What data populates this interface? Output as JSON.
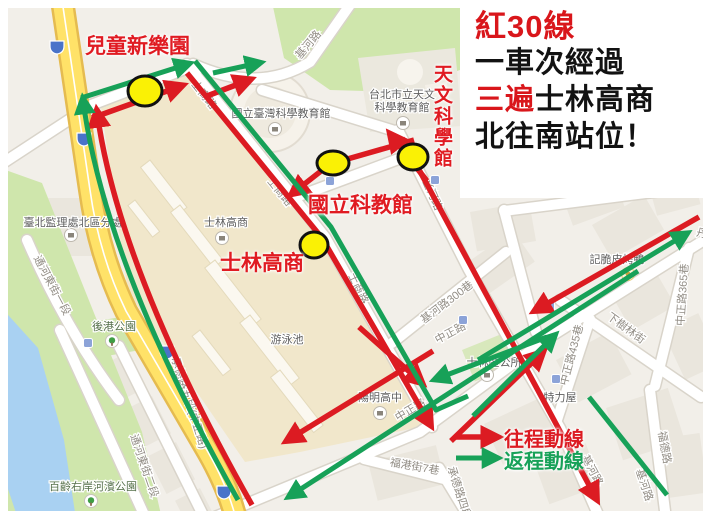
{
  "colors": {
    "route_red": "#DC1B22",
    "route_green": "#17A158",
    "stop_yellow": "#FAF105",
    "annotation_red": "#E01B22",
    "title_red": "#D9161B",
    "road_yellow": "#FFE268",
    "park_green": "#CFE6AC",
    "water_blue": "#A9D1F2"
  },
  "title_box": {
    "line1": "紅30線",
    "line2": "一車次經過",
    "line3_red": "三遍",
    "line3_black": "士林高商",
    "line4": "北往南站位！"
  },
  "stop_labels": {
    "ertong": "兒童新樂園",
    "tianwen": "天文科學館",
    "kejiao": "國立科教館",
    "shilin": "士林高商"
  },
  "legend": {
    "outbound": "往程動線",
    "inbound": "返程動線"
  },
  "map": {
    "streets": {
      "jihe": "基河路",
      "shishang": "士商路",
      "zhongzheng": "中正路",
      "jihe300": "基河路300巷",
      "zz365": "中正路365巷",
      "zz435": "中正路435巷",
      "xiashulin": "下樹林街",
      "chengde5": "承德路五段(中正路)",
      "chengde4": "承德路四段",
      "tonghe1": "通河東街一段",
      "tonghe2": "通河東街二段",
      "fugang7": "福港街7巷",
      "fude": "福德路",
      "danyang": "丹陽街"
    },
    "pois": {
      "sci_edu": "國立臺灣科學教育館",
      "astro_l1": "台北市立天文",
      "astro_l2": "科學教育館",
      "slhs": "士林高商",
      "pool": "游泳池",
      "yangming": "陽明高中",
      "dmv": "臺北監理處北區分處",
      "hougang": "後港公園",
      "bailing": "百齡右岸河濱公園",
      "office": "士林區公所",
      "duck": "記脆皮烤鴨",
      "tlw": "特力屋"
    }
  }
}
